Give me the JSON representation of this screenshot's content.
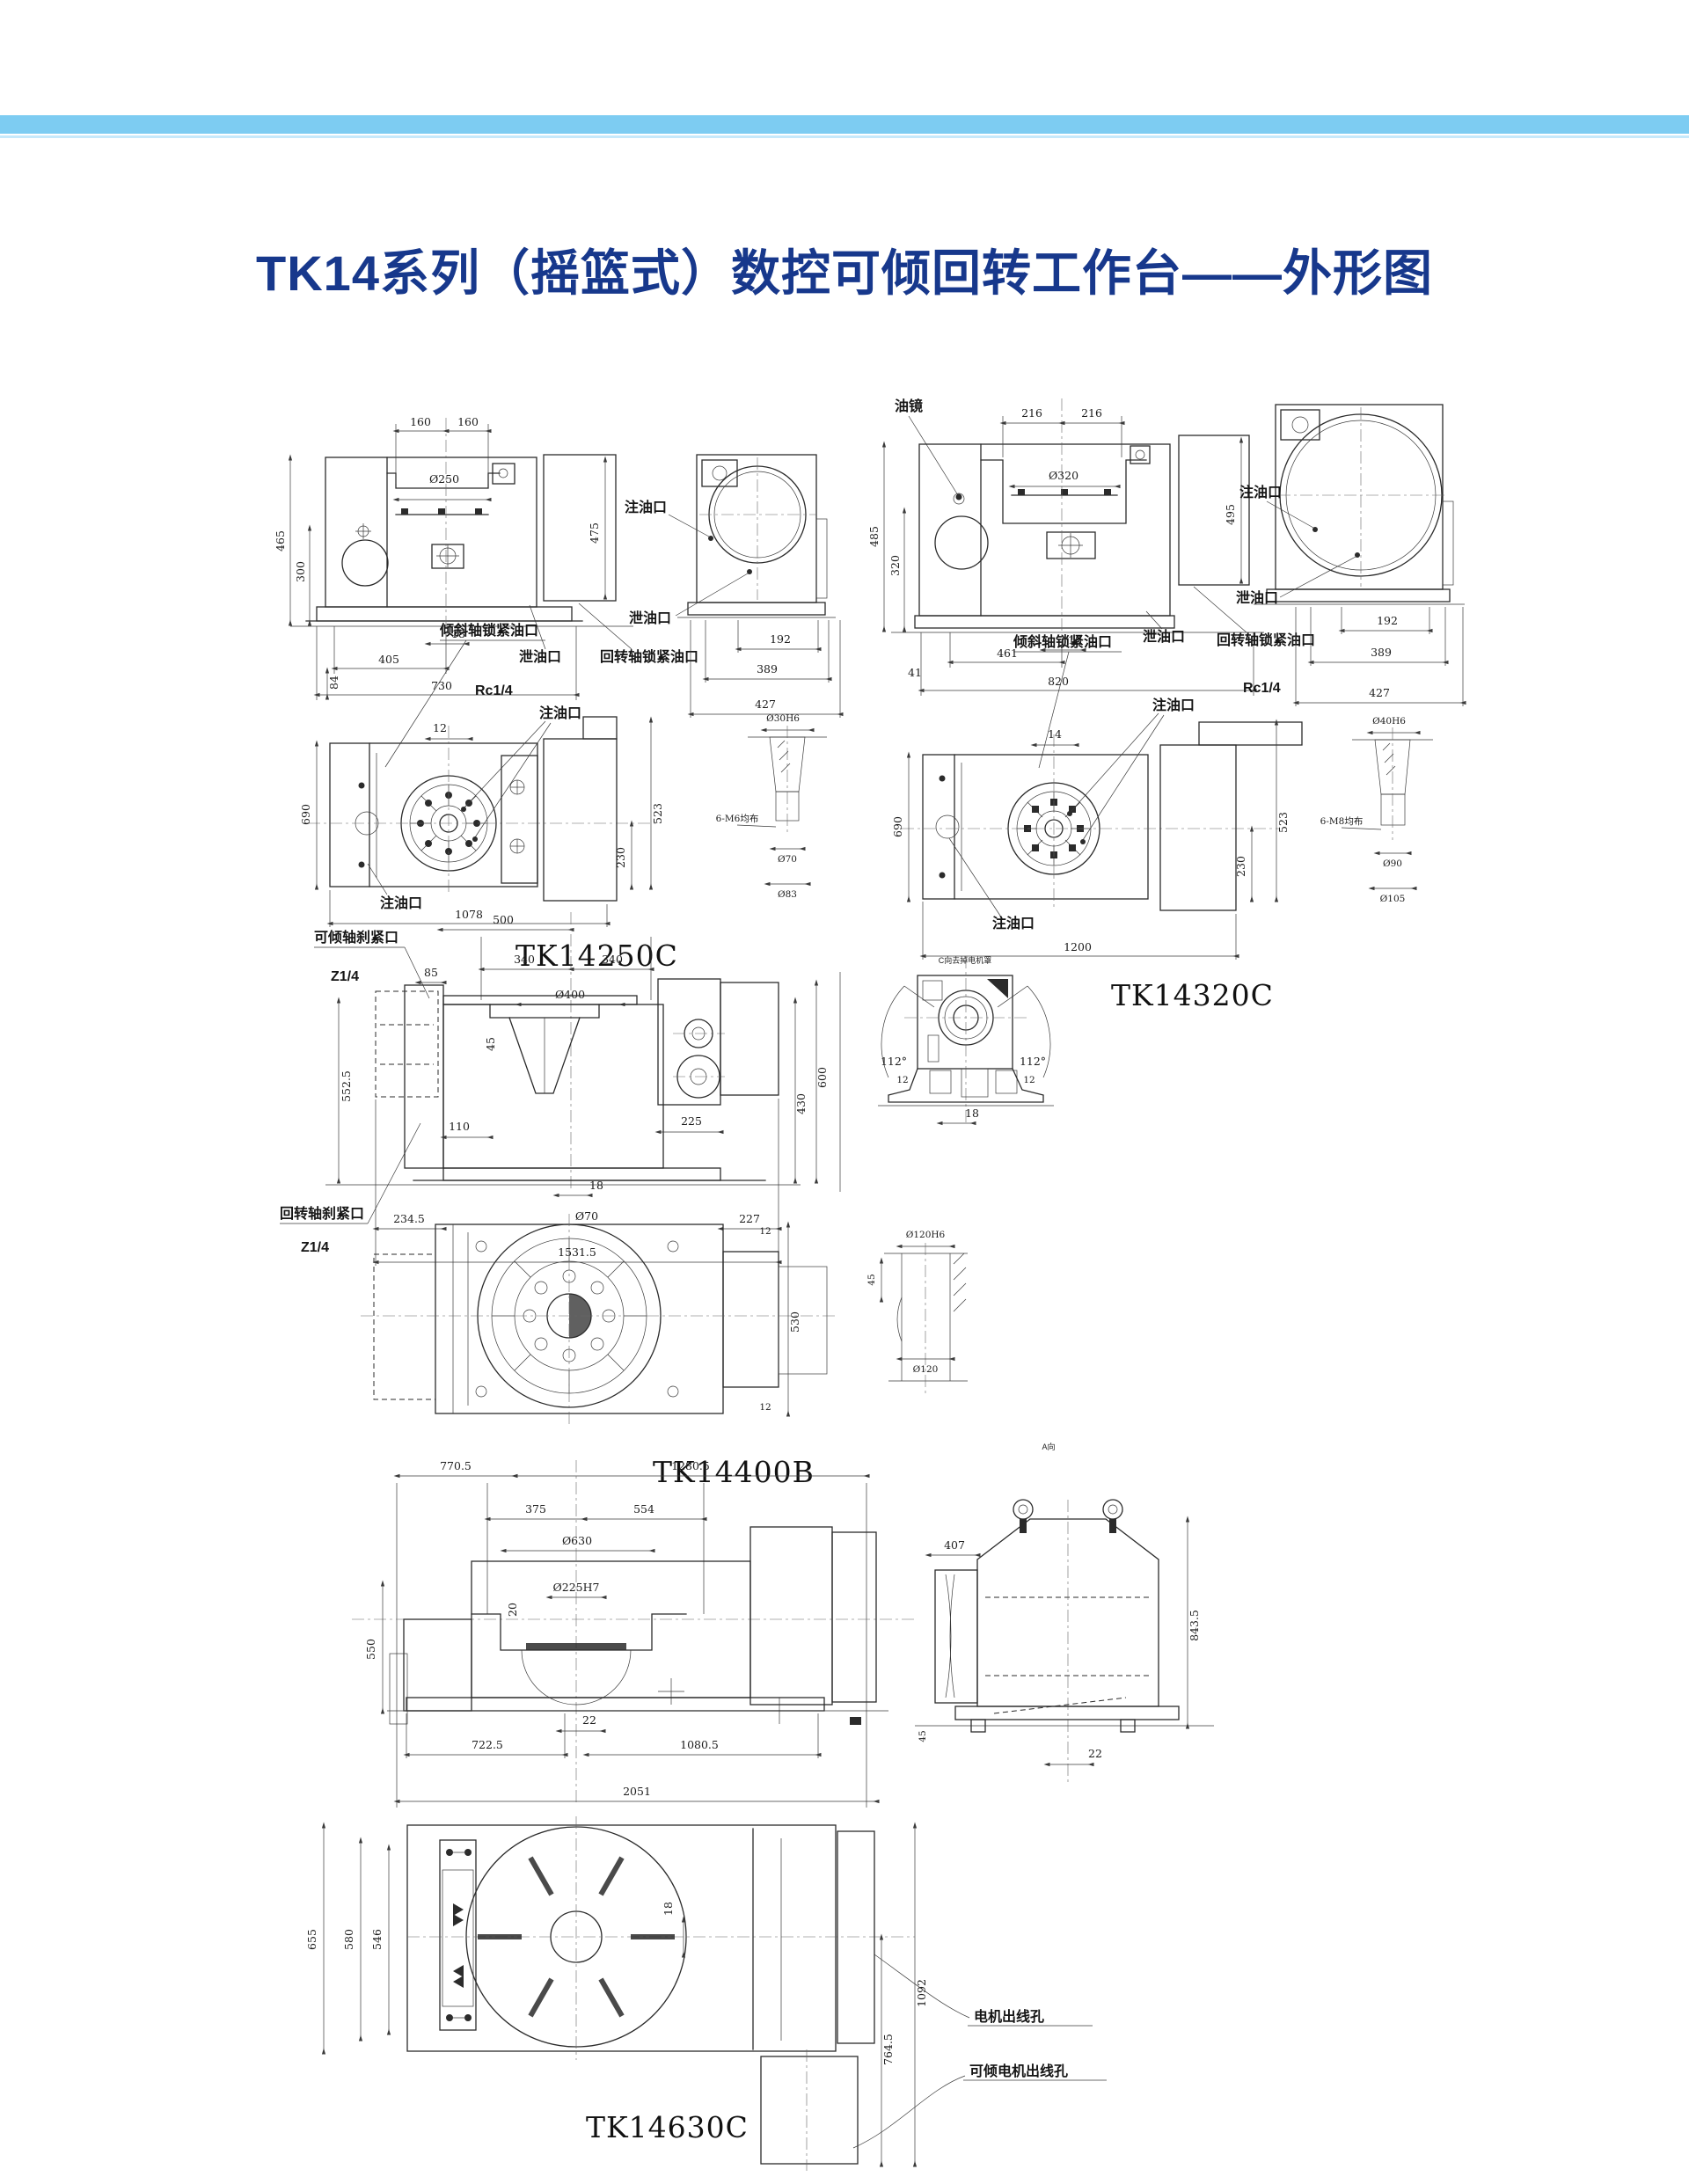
{
  "page": {
    "title": "TK14系列（摇篮式）数控可倾回转工作台——外形图",
    "accent_bar_color": "#7dccf2",
    "title_color": "#17388c"
  },
  "tk14250c": {
    "model": "TK14250C",
    "front": {
      "d160a": "160",
      "d160b": "160",
      "table_dia": "Ø250",
      "d465": "465",
      "d300": "300",
      "d475": "475",
      "d18": "18",
      "d405": "405",
      "d730": "730",
      "d84": "84"
    },
    "side": {
      "d192": "192",
      "d389": "389",
      "d427": "427"
    },
    "plan": {
      "d690": "690",
      "d12": "12",
      "d1078": "1078",
      "d523": "523",
      "d230": "230"
    },
    "detail": {
      "bore": "Ø30H6",
      "bolts": "6-M6均布",
      "d70": "Ø70",
      "d83": "Ø83"
    },
    "labels": {
      "oil_fill_side": "注油口",
      "drain_side": "泄油口",
      "drain": "泄油口",
      "rotary_lock": "回转轴锁紧油口",
      "thread": "Rc1/4",
      "tilt_lock": "倾斜轴锁紧油口",
      "oil_fill_plan": "注油口",
      "oil_fill_plan2": "注油口"
    }
  },
  "tk14320c": {
    "model": "TK14320C",
    "front": {
      "d216a": "216",
      "d216b": "216",
      "table_dia": "Ø320",
      "d485": "485",
      "d320": "320",
      "d495": "495",
      "d18": "18",
      "d461": "461",
      "d820": "820",
      "d41": "41"
    },
    "side": {
      "d192": "192",
      "d389": "389",
      "d427": "427"
    },
    "plan": {
      "d690": "690",
      "d14": "14",
      "d1200": "1200",
      "d523": "523",
      "d230": "230"
    },
    "detail": {
      "bore": "Ø40H6",
      "bolts": "6-M8均布",
      "d90": "Ø90",
      "d105": "Ø105"
    },
    "labels": {
      "oil_sight": "油镜",
      "oil_fill_side": "注油口",
      "drain_side": "泄油口",
      "drain": "泄油口",
      "rotary_lock": "回转轴锁紧油口",
      "thread": "Rc1/4",
      "tilt_lock": "倾斜轴锁紧油口",
      "oil_fill_plan": "注油口",
      "oil_fill_plan2": "注油口"
    }
  },
  "tk14400b": {
    "model": "TK14400B",
    "side": {
      "d500": "500",
      "d340a": "340",
      "d340b": "340",
      "table_dia": "Ø400",
      "d85": "85",
      "d45": "45",
      "d5525": "552.5",
      "d110": "110",
      "d225": "225",
      "d430": "430",
      "d600": "600",
      "d18": "18",
      "d70": "Ø70",
      "d2345": "234.5",
      "d15315": "1531.5",
      "d227": "227"
    },
    "endview": {
      "a112l": "112°",
      "a112r": "112°",
      "d12l": "12",
      "d12r": "12",
      "d18": "18",
      "caption": "C向去掉电机罩"
    },
    "plan": {
      "d530": "530",
      "d12t": "12",
      "d12b": "12"
    },
    "detail": {
      "bore": "Ø120H6",
      "d45": "45",
      "d120": "Ø120"
    },
    "labels": {
      "tilt_brake": "可倾轴刹紧口",
      "thread_t": "Z1/4",
      "rotary_brake": "回转轴刹紧口",
      "thread_b": "Z1/4"
    }
  },
  "tk14630c": {
    "model": "TK14630C",
    "front": {
      "d7705": "770.5",
      "d12805": "1280.5",
      "d375": "375",
      "d554": "554",
      "table_dia": "Ø630",
      "bore": "Ø225H7",
      "d20": "20",
      "d550": "550",
      "d22": "22",
      "d7225": "722.5",
      "d10805": "1080.5",
      "d2051": "2051"
    },
    "side": {
      "caption": "A向",
      "d407": "407",
      "d8435": "843.5",
      "d22": "22",
      "d45": "45"
    },
    "plan": {
      "d655": "655",
      "d580": "580",
      "d546": "546",
      "d18": "18",
      "d1092": "1092",
      "d7645": "764.5"
    },
    "labels": {
      "motor_hole": "电机出线孔",
      "tilt_motor_hole": "可倾电机出线孔"
    }
  }
}
